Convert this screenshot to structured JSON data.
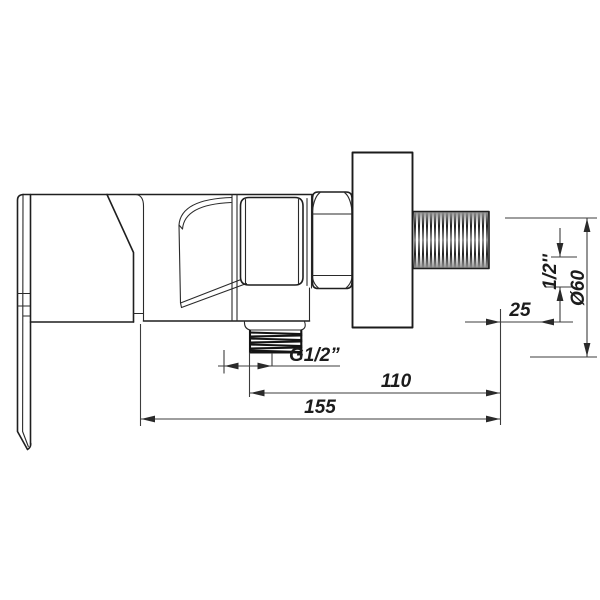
{
  "drawing": {
    "type": "technical-drawing",
    "subject": "wall-mounted mixer valve side view",
    "background": "#ffffff",
    "line_color": "#1f1f1f",
    "dim_color": "#3d3d3d"
  },
  "dimensions": {
    "outlet_thread_label": "G1/2”",
    "length_110": "110",
    "length_155": "155",
    "offset_25": "25",
    "inlet_thread_label": "1/2''",
    "diameter_label": "Ø60"
  }
}
